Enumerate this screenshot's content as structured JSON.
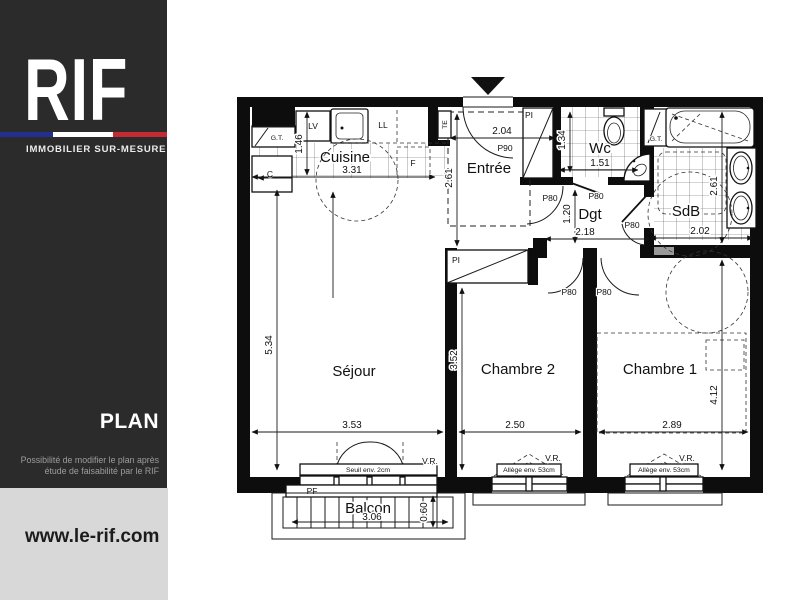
{
  "brand": {
    "logo": "RIF",
    "tagline": "IMMOBILIER SUR-MESURE",
    "section_title": "PLAN",
    "note_line1": "Possibilité de modifier le plan après",
    "note_line2": "étude de faisabilité par le RIF",
    "website": "www.le-rif.com",
    "colors": {
      "sidebar_bg": "#2b2b2b",
      "footer_bg": "#d8d8d8",
      "flag_blue": "#232f8e",
      "flag_white": "#ffffff",
      "flag_red": "#c32a33"
    }
  },
  "plan": {
    "rooms": {
      "cuisine": "Cuisine",
      "entree": "Entrée",
      "wc": "Wc",
      "dgt": "Dgt",
      "sdb": "SdB",
      "sejour": "Séjour",
      "chambre2": "Chambre 2",
      "chambre1": "Chambre 1",
      "balcon": "Balcon"
    },
    "dimensions": {
      "cuisine_width": "3.31",
      "cuisine_depth": "1.46",
      "entree_width": "2.04",
      "entree_depth": "2.61",
      "wc_depth": "1.34",
      "wc_width": "1.51",
      "sdb_width": "2.02",
      "sdb_depth": "2.61",
      "dgt_depth": "1.20",
      "dgt_width": "2.18",
      "sejour_depth": "5.34",
      "sejour_width": "3.53",
      "chambre2_depth": "3.52",
      "chambre2_width": "2.50",
      "chambre1_width": "2.89",
      "chambre1_depth": "4.12",
      "balcon_width": "3.06",
      "balcon_depth": "0.60"
    },
    "doors": {
      "p90": "P90",
      "p80": "P80"
    },
    "fixtures": {
      "lv": "LV",
      "ll": "LL",
      "te": "TE",
      "gt": "G.T.",
      "c": "C",
      "f": "F",
      "pi": "PI",
      "pf": "PF",
      "vr": "V.R."
    },
    "notes": {
      "seuil": "Seuil env. 2cm",
      "allege": "Allège env. 53cm"
    }
  }
}
